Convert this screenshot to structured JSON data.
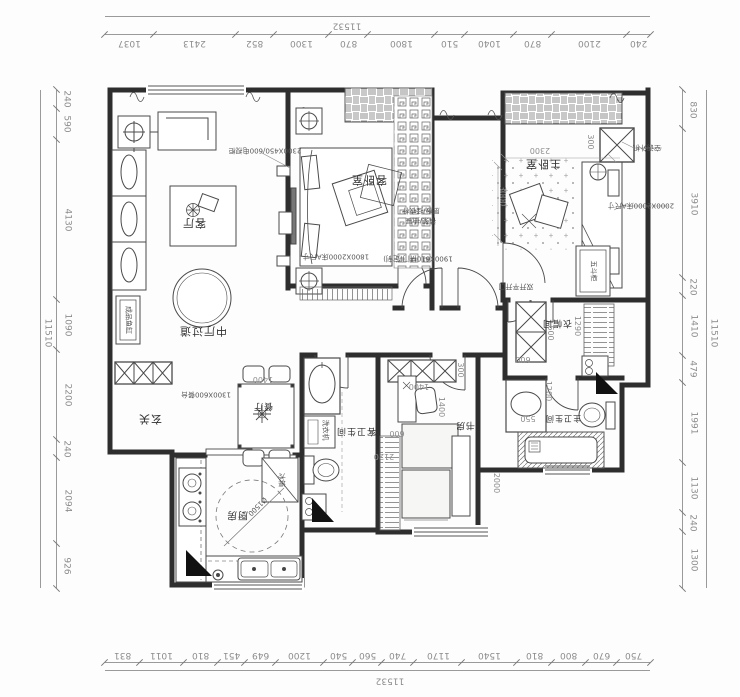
{
  "drawing": {
    "type": "apartment floor plan (rotated 180°)",
    "colors": {
      "wall": "#2e2e2e",
      "furniture": "#4a4a4a",
      "dim_text": "#8c8c8c",
      "marker": "#111111"
    }
  },
  "dims": {
    "top": {
      "total": "11532",
      "segments": [
        "1037",
        "2413",
        "852",
        "1300",
        "870",
        "1800",
        "510",
        "1040",
        "870",
        "2100",
        "240"
      ]
    },
    "bottom": {
      "total": "11532",
      "segments": [
        "831",
        "1011",
        "810",
        "451",
        "649",
        "1200",
        "540",
        "560",
        "740",
        "1170",
        "1540",
        "810",
        "800",
        "670",
        "750"
      ]
    },
    "left": {
      "total": "11510",
      "segments": [
        "240",
        "590",
        "4130",
        "1090",
        "2200",
        "240",
        "2094",
        "926"
      ]
    },
    "right": {
      "total": "11510",
      "segments": [
        "830",
        "3910",
        "220",
        "1410",
        "479",
        "1991",
        "1130",
        "240",
        "1300"
      ]
    }
  },
  "rooms": {
    "living": "客厅",
    "guest_bedroom": "客卧室",
    "master_bedroom": "主卧室",
    "hall": "中厅过道",
    "entry": "玄关",
    "dining": "餐厅",
    "kitchen": "厨房",
    "guest_bath": "客卫生间",
    "study": "书房",
    "master_bath": "主卫生间",
    "closet": "衣帽间"
  },
  "notes": {
    "tv_cabinet": "2300X450/600电视柜",
    "guest_bed_size": "1800X2000床A尺寸",
    "master_bed_size": "2000X2000床A尺寸",
    "dining_table": "1300X600餐台",
    "door_custom": "1900X610拼门(定制)",
    "double_door": "双开平开门",
    "ac_unit": "空调外机",
    "washer": "洗衣机",
    "fridge": "冰箱",
    "dresser": "五斗柜",
    "aquarium": "成品鱼缸",
    "turn_circle": "Ø1500",
    "shelf_note": "层板/挂衣杆",
    "drawer_note": "裤架/抽屉"
  },
  "inner_dims": {
    "d2300": "2300",
    "d3000": "3000",
    "d300a": "300",
    "d300b": "300",
    "d1400a": "1400",
    "d1400b": "1400",
    "d1400c": "1400",
    "d600a": "600",
    "d600b": "600",
    "d600c": "600",
    "d2120": "2120",
    "d2000": "2000",
    "d1290": "1290",
    "d1200": "1200",
    "d550": "550"
  }
}
